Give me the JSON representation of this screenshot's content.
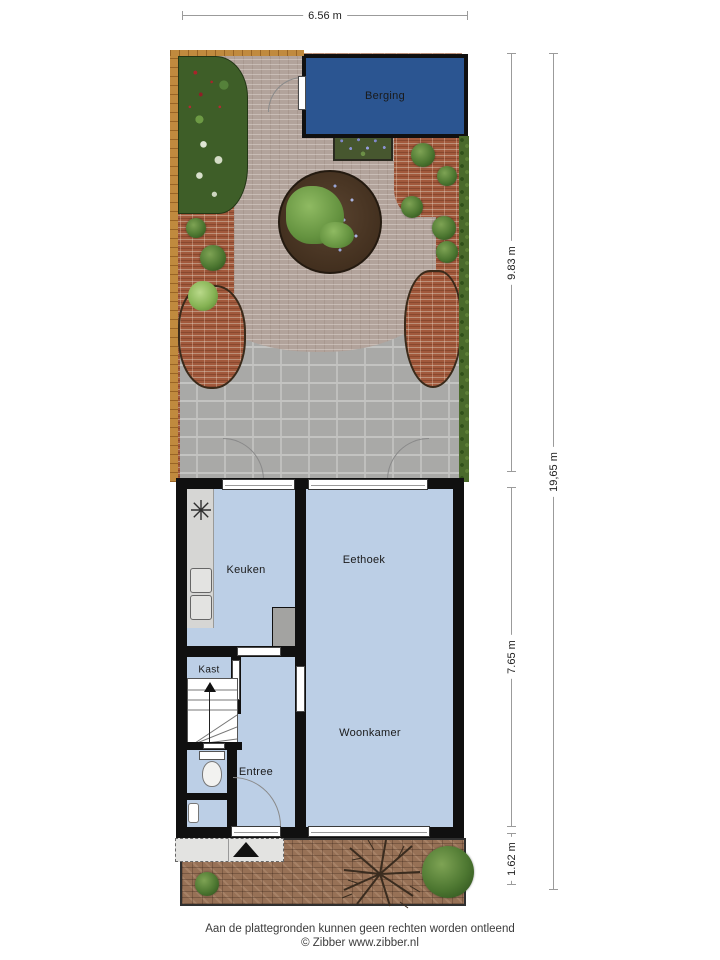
{
  "rooms": {
    "berging": "Berging",
    "keuken": "Keuken",
    "eethoek": "Eethoek",
    "kast": "Kast",
    "entree": "Entree",
    "woonkamer": "Woonkamer"
  },
  "dimensions": {
    "width_top": "6.56 m",
    "garden_depth": "9.83 m",
    "house_depth": "7.65 m",
    "front_yard_depth": "1.62 m",
    "total_depth": "19,65 m"
  },
  "footer": {
    "disclaimer": "Aan de plattegronden kunnen geen rechten worden ontleend",
    "copyright": "© Zibber www.zibber.nl"
  },
  "colors": {
    "berging_fill": "#2b5591",
    "floor_fill": "#bccfe6",
    "wall": "#101010",
    "garden_paving": "#b2a39b",
    "red_brick": "#a2593c",
    "terrace": "#a9a9a7",
    "front_yard_brick": "#977156",
    "fence": "#c08a3e",
    "hedge": "#4a6a2b"
  }
}
